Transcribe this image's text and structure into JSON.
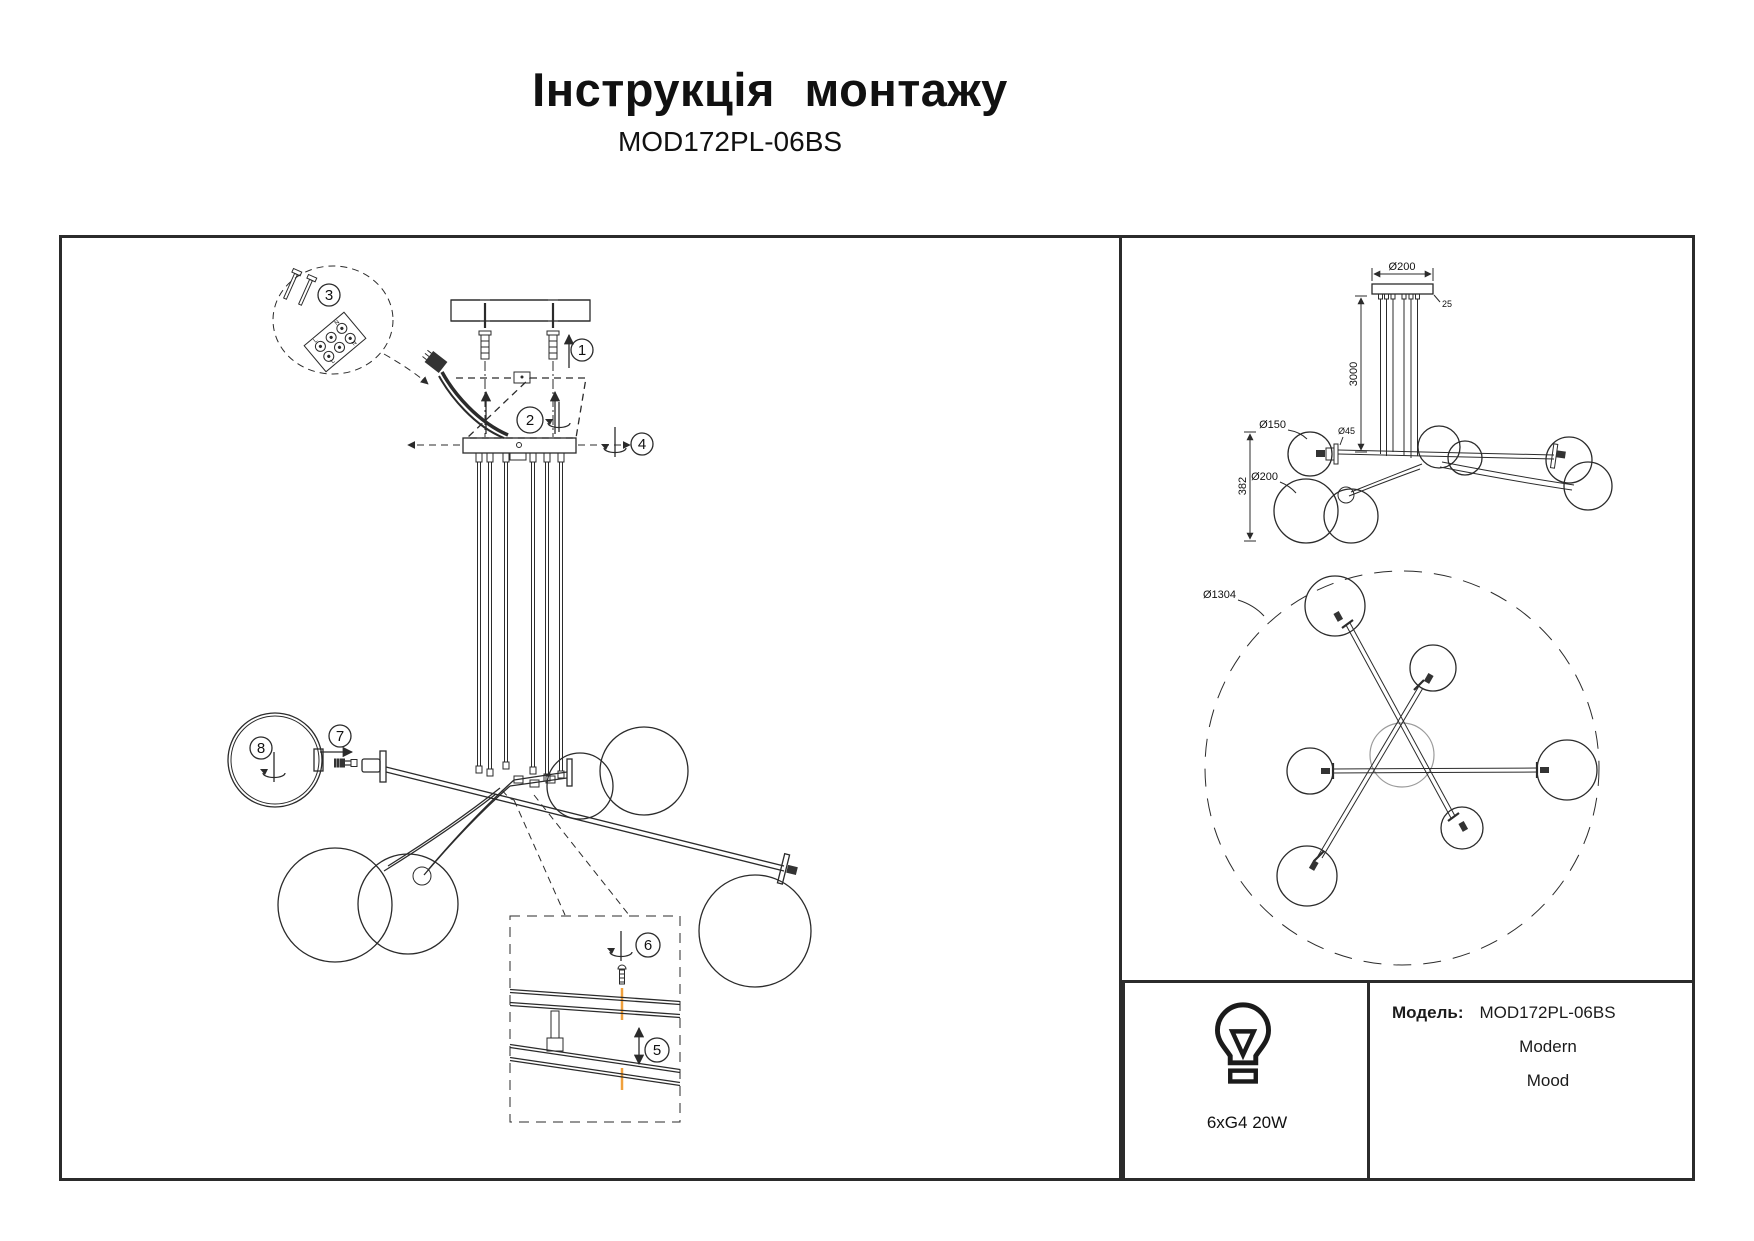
{
  "header": {
    "title": "Інструкція монтажу",
    "subtitle": "MOD172PL-06BS"
  },
  "assembly": {
    "callouts": {
      "1": "1",
      "2": "2",
      "3": "3",
      "4": "4",
      "5": "5",
      "6": "6",
      "7": "7",
      "8": "8"
    }
  },
  "terminal_block": {
    "l": "L",
    "n": "N"
  },
  "side_view": {
    "canopy_diameter": "Ø200",
    "canopy_height": "25",
    "suspension_length": "3000",
    "globe_small": "Ø150",
    "socket_diameter": "Ø45",
    "globe_large": "Ø200",
    "body_height": "382"
  },
  "top_view": {
    "fixture_diameter": "Ø1304"
  },
  "lamp_spec": {
    "bulbs": "6xG4 20W"
  },
  "model_info": {
    "label": "Модель:",
    "model": "MOD172PL-06BS",
    "style": "Modern",
    "collection": "Mood"
  },
  "colors": {
    "line": "#2b2b2b",
    "accent_screw_hole": "#f0a03c"
  }
}
